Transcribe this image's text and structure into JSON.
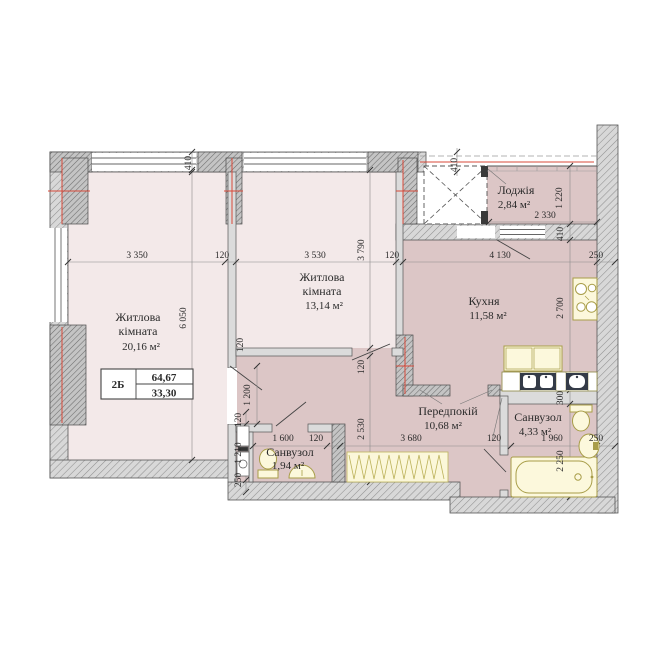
{
  "unit": {
    "type": "2Б",
    "area_total": "64,67",
    "area_living": "33,30"
  },
  "rooms": {
    "room1": {
      "name1": "Житлова",
      "name2": "кімната",
      "area": "20,16 м²"
    },
    "room2": {
      "name1": "Житлова",
      "name2": "кімната",
      "area": "13,14 м²"
    },
    "kitchen": {
      "name": "Кухня",
      "area": "11,58 м²"
    },
    "loggia": {
      "name": "Лоджія",
      "area": "2,84 м²"
    },
    "hall": {
      "name": "Передпокій",
      "area": "10,68 м²"
    },
    "bath_big": {
      "name": "Санвузол",
      "area": "4,33 м²"
    },
    "bath_small": {
      "name": "Санвузол",
      "area": "1,94 м²"
    }
  },
  "dims": {
    "w_room1": "3 350",
    "w_room2": "3 530",
    "w_kitchen": "4 130",
    "h_room1": "6 050",
    "h_room2": "3 790",
    "t_wall_top": "410",
    "t_wall": "120",
    "t_250": "250",
    "w_loggia": "2 330",
    "h_loggia": "1 220",
    "h_kitchen": "2 700",
    "t_wall_kb": "300",
    "w_bath_big": "1 960",
    "h_bath_big": "2 250",
    "h_hall": "2 530",
    "w_hall": "3 680",
    "door_room1": "1 200",
    "w_bath_small": "1 600",
    "h_bath_small": "1 210"
  },
  "colors": {
    "floor_light": "#f3e9e9",
    "floor_dark": "#dcc6c6",
    "axis_red": "#d84a3a",
    "fixture_stroke": "#a89d48",
    "fixture_fill": "#fcf8dc",
    "sink_dark": "#343b47"
  }
}
